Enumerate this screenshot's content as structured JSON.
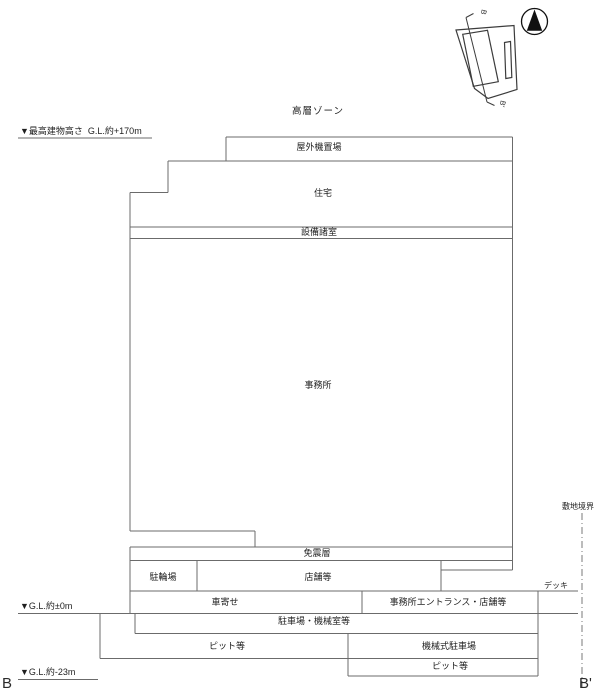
{
  "title": "高層ゾーン",
  "elevation_labels": {
    "max_height": "▼最高建物高さ  G.L.約+170m",
    "ground": "▼G.L.約±0m",
    "basement": "▼G.L.約-23m"
  },
  "section_markers": {
    "left": "B",
    "right": "B'"
  },
  "site": {
    "boundary": "敷地境界",
    "deck": "デッキ"
  },
  "key_plan": {
    "top_marker": "B",
    "bottom_marker": "B'"
  },
  "rooms": {
    "outdoor_equipment": "屋外機置場",
    "residential": "住宅",
    "equipment_rooms": "設備諸室",
    "office": "事務所",
    "seismic_isolation_layer": "免震層",
    "bicycle_parking": "駐輪場",
    "shops": "店舗等",
    "driveway": "車寄せ",
    "office_entrance_shops": "事務所エントランス・店舗等",
    "parking_machine_rooms": "駐車場・機械室等",
    "pit_b1": "ピット等",
    "mechanical_parking": "機械式駐車場",
    "pit_b2": "ピット等"
  },
  "colors": {
    "line": "#6b6b6b",
    "text": "#1f1f1f"
  }
}
